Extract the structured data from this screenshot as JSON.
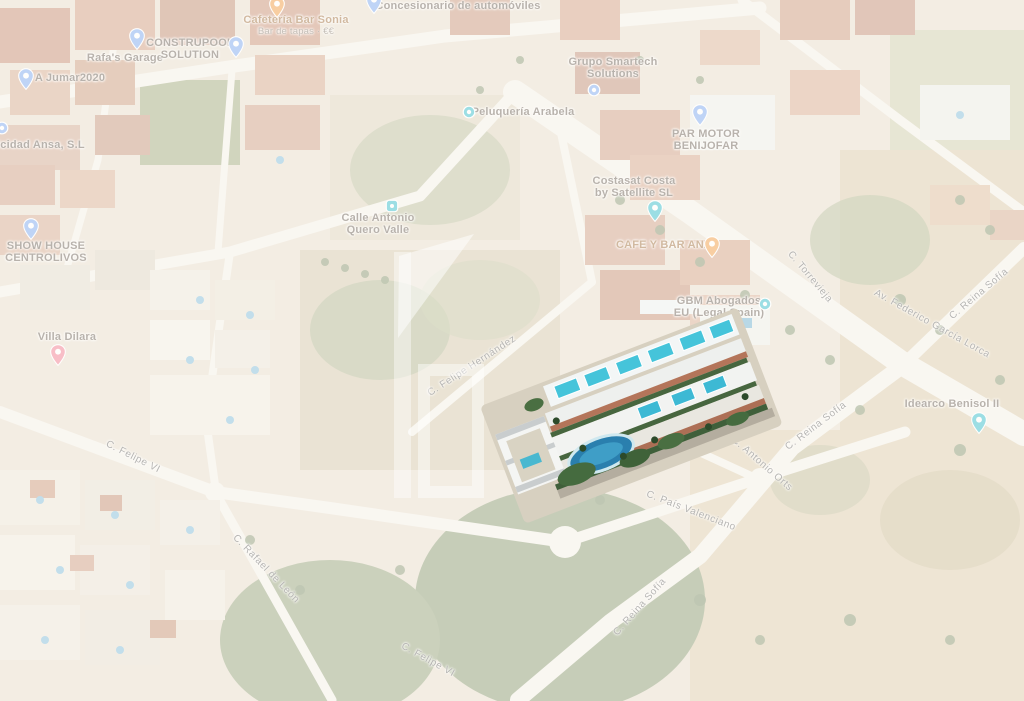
{
  "map": {
    "pois": [
      {
        "id": "cafeteria-bar-sonia",
        "lines": [
          "Cafetería Bar Sonia"
        ],
        "sub": "Bar de tapas · €€",
        "tx": 296,
        "ty": 14,
        "color": "food",
        "pin": {
          "shape": "pin",
          "color": "food",
          "px": 277,
          "py": 18
        }
      },
      {
        "id": "concesionario-de-automoviles",
        "lines": [
          "Concesionario de automóviles"
        ],
        "tx": 458,
        "ty": 0,
        "color": "default",
        "pin": {
          "shape": "pin",
          "color": "default",
          "px": 374,
          "py": 14
        }
      },
      {
        "id": "rafas-garage",
        "lines": [
          "Rafa's Garage"
        ],
        "tx": 125,
        "ty": 52,
        "color": "default",
        "pin": {
          "shape": "pin",
          "color": "default",
          "px": 137,
          "py": 50
        }
      },
      {
        "id": "construpool-solution",
        "lines": [
          "CONSTRUPOOL",
          "SOLUTION"
        ],
        "tx": 190,
        "ty": 37,
        "color": "default",
        "pin": {
          "shape": "pin",
          "color": "default",
          "px": 236,
          "py": 58
        }
      },
      {
        "id": "a-jumar2020",
        "lines": [
          "A Jumar2020"
        ],
        "tx": 70,
        "ty": 72,
        "color": "default",
        "pin": {
          "shape": "pin",
          "color": "default",
          "px": 26,
          "py": 90
        }
      },
      {
        "id": "electricidad-ansa",
        "lines": [
          "Electricidad Ansa, S.L"
        ],
        "tx": 25,
        "ty": 139,
        "color": "default",
        "pin": {
          "shape": "circle",
          "color": "default",
          "px": 2,
          "py": 128
        }
      },
      {
        "id": "grupo-smartech-solutions",
        "lines": [
          "Grupo Smartech",
          "Solutions"
        ],
        "tx": 613,
        "ty": 56,
        "color": "default",
        "pin": {
          "shape": "circle",
          "color": "default",
          "px": 594,
          "py": 90
        }
      },
      {
        "id": "peluqueria-arabela",
        "lines": [
          "Peluquería Arabela"
        ],
        "tx": 523,
        "ty": 106,
        "color": "default",
        "pin": {
          "shape": "circle",
          "color": "services",
          "px": 469,
          "py": 112
        }
      },
      {
        "id": "par-motor-benijofar",
        "lines": [
          "PAR MOTOR",
          "BENIJOFAR"
        ],
        "tx": 706,
        "ty": 128,
        "color": "default",
        "pin": {
          "shape": "pin",
          "color": "default",
          "px": 700,
          "py": 126
        }
      },
      {
        "id": "costasat-costa-by-satellite",
        "lines": [
          "Costasat Costa",
          "by Satellite SL"
        ],
        "tx": 634,
        "ty": 175,
        "color": "default",
        "pin": {
          "shape": "pin",
          "color": "services",
          "px": 655,
          "py": 222
        }
      },
      {
        "id": "calle-antonio-quero-valle",
        "lines": [
          "Calle Antonio",
          "Quero Valle"
        ],
        "tx": 378,
        "ty": 212,
        "color": "default",
        "pin": {
          "shape": "square",
          "color": "services",
          "px": 392,
          "py": 206
        }
      },
      {
        "id": "show-house-centrolivos",
        "lines": [
          "SHOW HOUSE",
          "CENTROLIVOS"
        ],
        "tx": 46,
        "ty": 240,
        "color": "default",
        "pin": {
          "shape": "pin",
          "color": "default",
          "px": 31,
          "py": 240
        }
      },
      {
        "id": "villa-dilara",
        "lines": [
          "Villa Dilara"
        ],
        "tx": 67,
        "ty": 331,
        "color": "default",
        "pin": {
          "shape": "pin",
          "color": "lodging",
          "px": 58,
          "py": 366
        }
      },
      {
        "id": "cafe-y-bar-ana",
        "lines": [
          "CAFE Y BAR ANA"
        ],
        "tx": 664,
        "ty": 239,
        "color": "food",
        "pin": {
          "shape": "pin",
          "color": "food",
          "px": 712,
          "py": 258
        }
      },
      {
        "id": "gbm-abogados",
        "lines": [
          "GBM Abogados",
          "EU (Legal Spain)"
        ],
        "tx": 719,
        "ty": 295,
        "color": "default",
        "pin": {
          "shape": "circle",
          "color": "services",
          "px": 765,
          "py": 304
        }
      },
      {
        "id": "idearco-benisol-ii",
        "lines": [
          "Idearco Benisol II"
        ],
        "tx": 952,
        "ty": 398,
        "color": "default",
        "pin": {
          "shape": "pin",
          "color": "services",
          "px": 979,
          "py": 434
        }
      }
    ],
    "streets": [
      {
        "text": "C. Torrevieja",
        "x": 810,
        "y": 277,
        "angle": 50
      },
      {
        "text": "Av. Federico García Lorca",
        "x": 932,
        "y": 324,
        "angle": 29
      },
      {
        "text": "C. Reina Sofía",
        "x": 979,
        "y": 294,
        "angle": -40
      },
      {
        "text": "C. Reina Sofía",
        "x": 816,
        "y": 426,
        "angle": -37
      },
      {
        "text": "C. Antonio Orts",
        "x": 762,
        "y": 464,
        "angle": 41
      },
      {
        "text": "C. País Valenciano",
        "x": 691,
        "y": 511,
        "angle": 21
      },
      {
        "text": "C. Reina Sofía",
        "x": 640,
        "y": 607,
        "angle": -48
      },
      {
        "text": "C. Felipe VI",
        "x": 428,
        "y": 660,
        "angle": 29
      },
      {
        "text": "C. Felipe VI",
        "x": 133,
        "y": 457,
        "angle": 27
      },
      {
        "text": "C. Rafael de León",
        "x": 266,
        "y": 569,
        "angle": 46
      },
      {
        "text": "C. Felipe Hernández",
        "x": 472,
        "y": 366,
        "angle": -33
      }
    ],
    "pin_colors": {
      "default": "#6f9ff2",
      "services": "#1fb6c9",
      "food": "#ef9234",
      "lodging": "#ee6e87"
    },
    "label_colors": {
      "poi": "#5d5349",
      "food": "#97622e",
      "street": "#585858"
    }
  },
  "development": {
    "render_colors": {
      "facade": "#f4f5f2",
      "terrace": "#b4755a",
      "rooftop_pool": "#45c4da",
      "main_pool": "#2a7fae",
      "garden": "#456b3f"
    }
  }
}
